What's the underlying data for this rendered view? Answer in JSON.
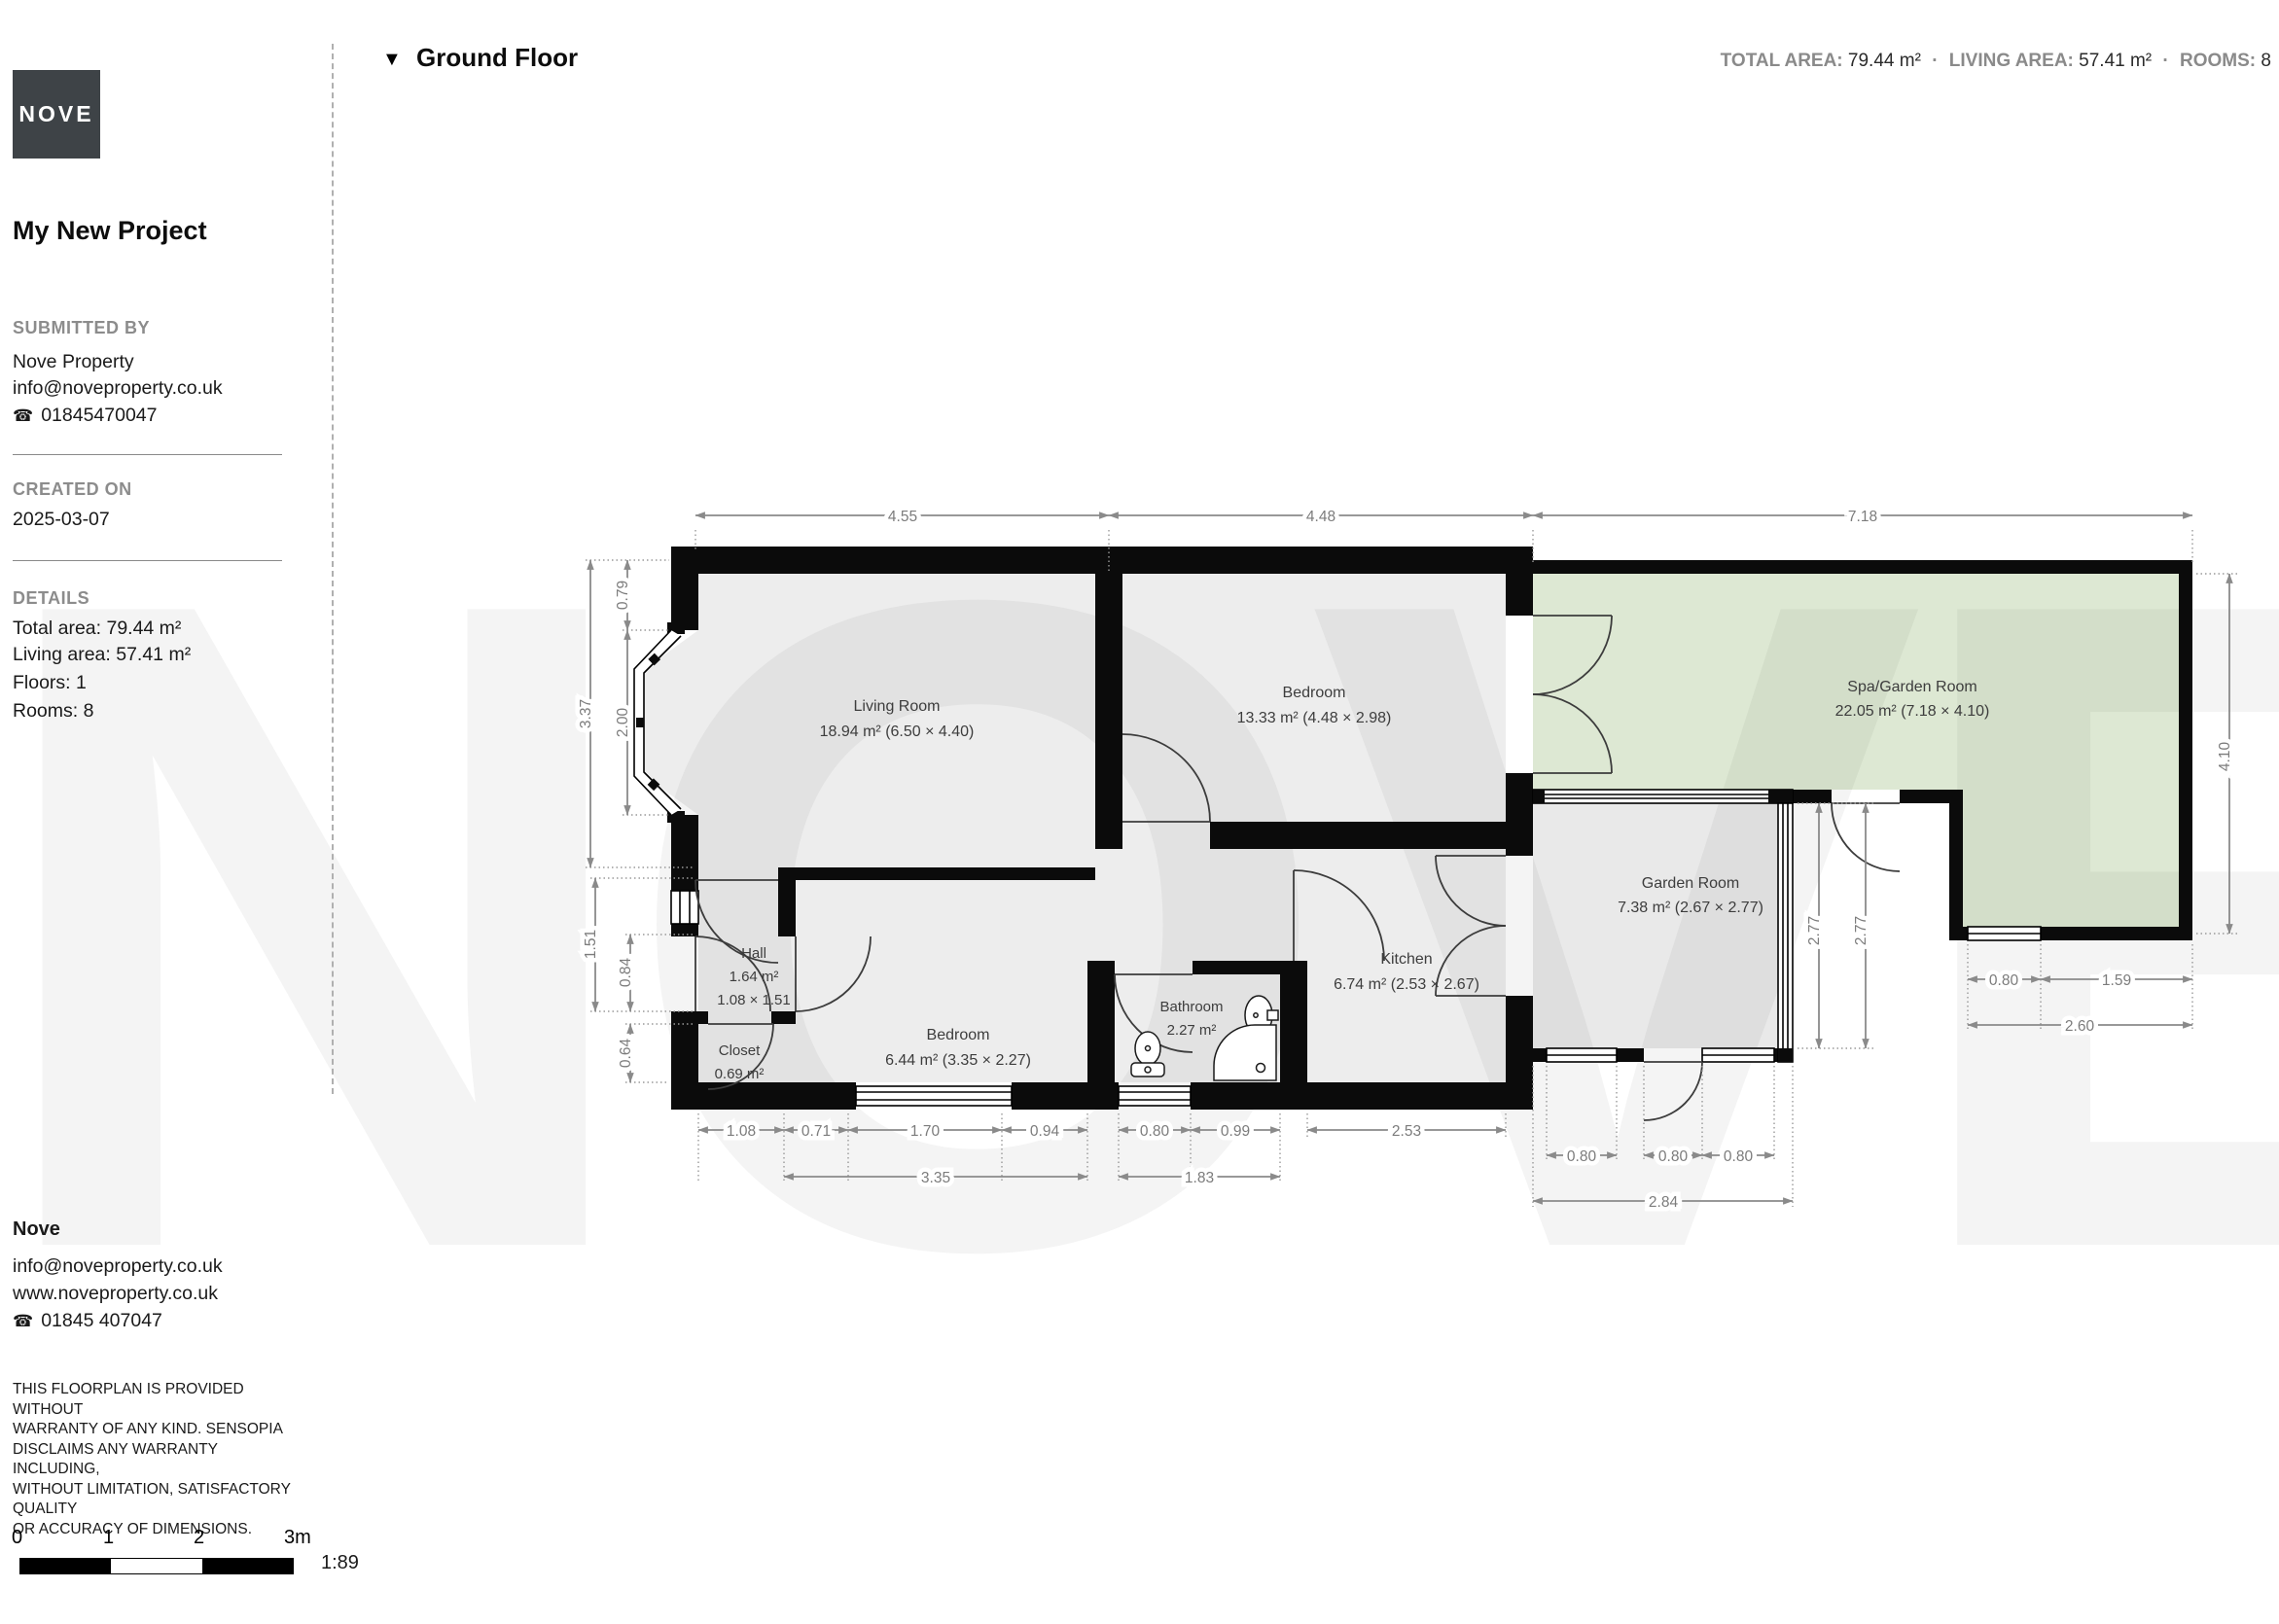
{
  "header": {
    "floor_label": "Ground Floor",
    "stats": {
      "total_label": "TOTAL AREA:",
      "total_value": "79.44 m²",
      "living_label": "LIVING AREA:",
      "living_value": "57.41 m²",
      "rooms_label": "ROOMS:",
      "rooms_value": "8",
      "separator": "·"
    }
  },
  "sidebar": {
    "logo_text": "NOVE",
    "project_title": "My New Project",
    "submitted_by_label": "SUBMITTED BY",
    "company": "Nove Property",
    "email": "info@noveproperty.co.uk",
    "phone": "01845470047",
    "created_on_label": "CREATED ON",
    "created_on": "2025-03-07",
    "details_label": "DETAILS",
    "total_area": "Total area: 79.44 m²",
    "living_area": "Living area: 57.41 m²",
    "floors": "Floors: 1",
    "rooms": "Rooms: 8"
  },
  "footer": {
    "company": "Nove",
    "email": "info@noveproperty.co.uk",
    "website": "www.noveproperty.co.uk",
    "phone": "01845 407047",
    "disclaimer": "THIS FLOORPLAN IS PROVIDED WITHOUT\nWARRANTY OF ANY KIND. SENSOPIA\nDISCLAIMS ANY WARRANTY INCLUDING,\nWITHOUT LIMITATION, SATISFACTORY QUALITY\nOR ACCURACY OF DIMENSIONS.",
    "scale": {
      "t0": "0",
      "t1": "1",
      "t2": "2",
      "t3": "3m",
      "ratio": "1:89"
    }
  },
  "plan": {
    "watermark": "NOVE",
    "colors": {
      "spa_fill": "#dde8d3",
      "floor_fill": "#ededed",
      "wall": "#0b0b0b",
      "dim": "#7c7c7c"
    },
    "rooms": {
      "living": {
        "name": "Living Room",
        "size": "18.94 m² (6.50 × 4.40)"
      },
      "bedroom1": {
        "name": "Bedroom",
        "size": "13.33 m² (4.48 × 2.98)"
      },
      "spa": {
        "name": "Spa/Garden Room",
        "size": "22.05 m² (7.18 × 4.10)"
      },
      "garden": {
        "name": "Garden Room",
        "size": "7.38 m² (2.67 × 2.77)"
      },
      "kitchen": {
        "name": "Kitchen",
        "size": "6.74 m² (2.53 × 2.67)"
      },
      "bathroom": {
        "name": "Bathroom",
        "size": "2.27 m²"
      },
      "bedroom2": {
        "name": "Bedroom",
        "size": "6.44 m² (3.35 × 2.27)"
      },
      "hall": {
        "name": "Hall",
        "size": "1.64 m²",
        "dims": "1.08 × 1.51"
      },
      "closet": {
        "name": "Closet",
        "size": "0.69 m²"
      }
    },
    "dims": {
      "top": [
        "4.55",
        "4.48",
        "7.18"
      ],
      "left_total": "3.37",
      "left": [
        "0.79",
        "2.00"
      ],
      "left_lower": [
        "1.51",
        "0.84",
        "0.64"
      ],
      "right": "4.10",
      "bottom_row1": [
        "1.08",
        "0.71",
        "1.70",
        "0.94",
        "0.80",
        "0.99",
        "2.53"
      ],
      "bottom_row2": [
        "3.35",
        "1.83"
      ],
      "garden_bottom": [
        "0.80",
        "0.80",
        "0.80"
      ],
      "garden_total": "2.84",
      "garden_height": [
        "2.77",
        "2.77"
      ],
      "spa_bottom": [
        "0.80",
        "1.59"
      ],
      "spa_total": "2.60"
    }
  }
}
